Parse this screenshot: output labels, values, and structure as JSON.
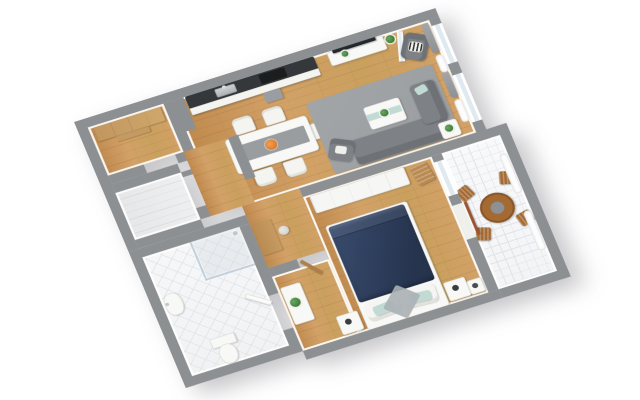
{
  "scene": {
    "type": "3d-floor-plan-render",
    "view": "isometric top-down view rotated counterclockwise, apartment on white background",
    "visible_text": "none",
    "rooms": [
      {
        "name": "walk-in-closet",
        "floor": "wood",
        "furniture": [
          "wooden wardrobe shelf"
        ]
      },
      {
        "name": "open-living-kitchen-dining-room",
        "floor": "wood",
        "furniture": [
          "white kitchen counter with dark top",
          "sink",
          "black cooktop",
          "gray under-counter unit",
          "white tv sideboard with plant",
          "wall tv",
          "open glass door",
          "white dining table with gray runner",
          "orange bowl",
          "five white chairs",
          "gray rug",
          "gray sofa with chaise",
          "gray armchair",
          "white coffee table with plant and teal runner",
          "white side table with plant",
          "gray reading armchair with striped pillow",
          "floor plant",
          "gray curtains",
          "white radiators",
          "windows"
        ]
      },
      {
        "name": "left-balcony",
        "floor": "gray-planks",
        "furniture": []
      },
      {
        "name": "hallway",
        "floor": "wood",
        "furniture": [
          "wooden desk",
          "stool"
        ]
      },
      {
        "name": "bathroom",
        "floor": "white-diagonal-tiles",
        "furniture": [
          "corner shower with glass panels",
          "white sink",
          "toilet",
          "open white door"
        ]
      },
      {
        "name": "bedroom",
        "floor": "wood",
        "furniture": [
          "double bed with navy duvet",
          "two white pillows",
          "two teal accent pillows",
          "two white nightstands with clocks",
          "white wardrobe",
          "wooden valet stand",
          "white dresser with plant",
          "white deco box",
          "open wooden door"
        ]
      },
      {
        "name": "right-balcony",
        "floor": "white-grid-tiles",
        "furniture": [
          "round wooden table with gray center",
          "four wooden folding chairs",
          "two white planters",
          "open brown door"
        ]
      }
    ],
    "palette": {
      "wall": "#8d9093",
      "wallFace": "#ffffff",
      "wood": "#d2a167",
      "wood2": "#caa05e",
      "woodDark": "#c08a4e",
      "tileLine": "#dfe2e7",
      "rug": "#9b9ea1",
      "sofa": "#7e8286",
      "sofaDark": "#6e7276",
      "navy": "#2e3e5c",
      "navyDark": "#26344e",
      "teal": "#c2dad4",
      "orange": "#dd7f2e",
      "woodFurn": "#a46a33",
      "plant": "#3f7e3b",
      "white": "#f8f8f6",
      "counter": "#35383b",
      "curtain": "#9a9da0",
      "steel": "#c4c7ca"
    }
  }
}
